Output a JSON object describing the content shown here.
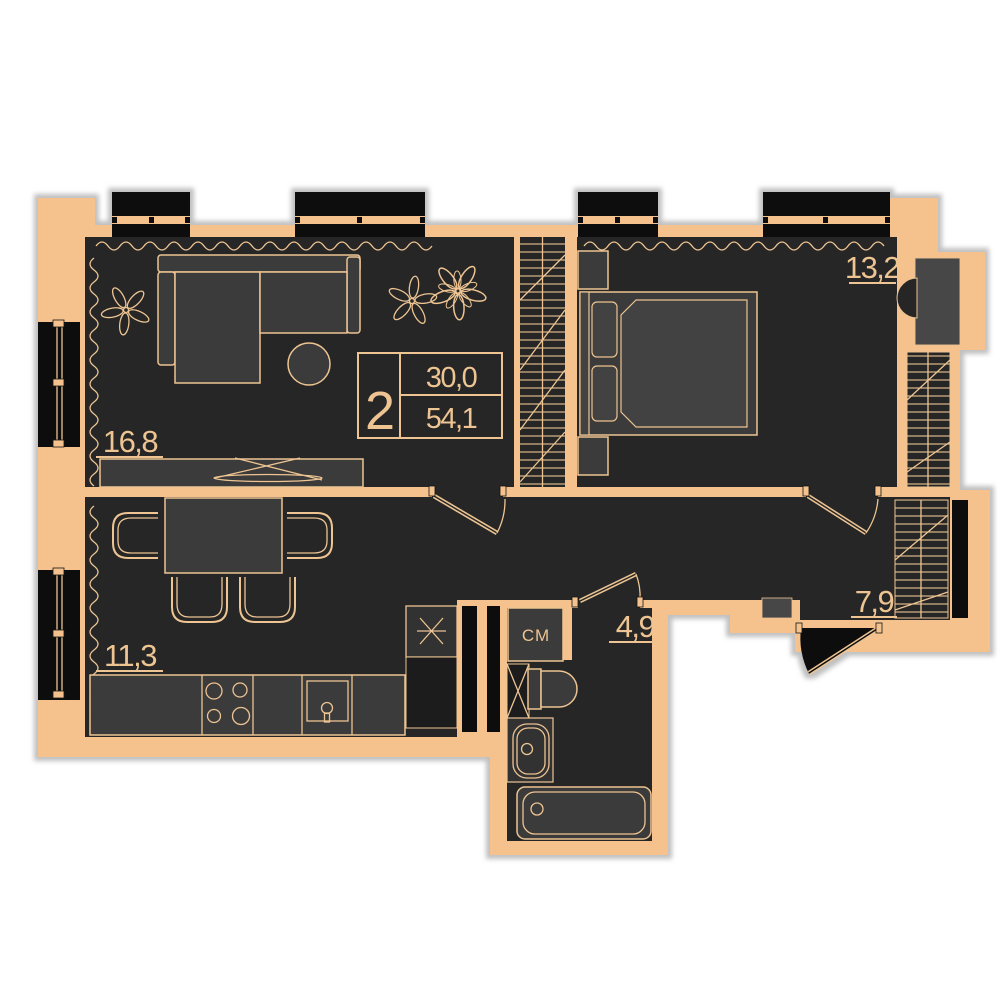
{
  "colors": {
    "bg": "#ffffff",
    "wall": "#f5c28d",
    "room": "#272727",
    "furn": "#3a3a3a",
    "line": "#edc492",
    "black": "#0b0b0b",
    "door": "#474747",
    "shadow": "#b0b0b0"
  },
  "info_box": {
    "rooms_count": "2",
    "living_area": "30,0",
    "total_area": "54,1"
  },
  "room_labels": {
    "living": "16,8",
    "bedroom": "13,2",
    "kitchen": "11,3",
    "bathroom": "4,9",
    "hallway": "7,9"
  },
  "fixtures": {
    "washing_machine": "СМ"
  }
}
